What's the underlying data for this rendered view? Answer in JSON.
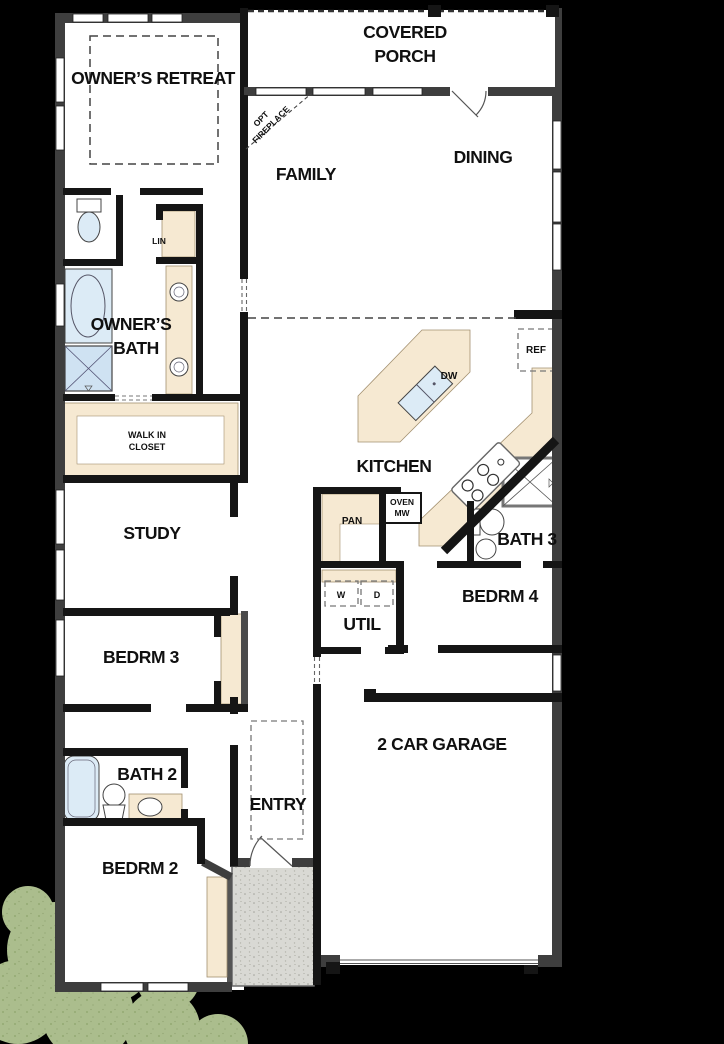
{
  "document": {
    "type": "residential-floor-plan",
    "background_color": "#000000"
  },
  "colors": {
    "exterior_wall": "#3e3e3e",
    "interior_wall": "#151515",
    "floor": "#ffffff",
    "cabinet_counter": "#f6e9d2",
    "plumbing_fixture": "#dcebf6",
    "stoop_concrete": "#d9d9d4",
    "bush_green": "#abbd8d",
    "label_text": "#101010"
  },
  "labels": {
    "owners_retreat": "OWNER’S RETREAT",
    "covered": "COVERED",
    "porch": "PORCH",
    "family": "FAMILY",
    "dining": "DINING",
    "opt": "OPT",
    "fireplace": "FIREPLACE",
    "lin": "LIN",
    "owners": "OWNER’S",
    "bath": "BATH",
    "walk_in": "WALK IN",
    "closet": "CLOSET",
    "kitchen": "KITCHEN",
    "dw": "DW",
    "ref": "REF",
    "study": "STUDY",
    "pan": "PAN",
    "oven": "OVEN",
    "mw": "MW",
    "bath3": "BATH 3",
    "bedrm4": "BEDRM 4",
    "util": "UTIL",
    "w": "W",
    "d": "D",
    "bedrm3": "BEDRM 3",
    "bath2": "BATH 2",
    "bedrm2": "BEDRM 2",
    "entry": "ENTRY",
    "garage": "2 CAR GARAGE"
  },
  "icons": {
    "toilet-icon": "tank rectangle + bowl ellipse",
    "tub-icon": "oval inside rectangle",
    "shower-icon": "square with X and drain marker",
    "sink-icon": "circle basin",
    "cooktop-icon": "four burner circles",
    "door-swing-icon": "quarter arc with leaf",
    "washer-dryer-icon": "dashed squares W / D",
    "refrigerator-icon": "dashed rectangle REF",
    "bed-icon": "dashed rectangle (optional bed location)",
    "bush-icon": "overlapping green circles",
    "porch-post-icon": "solid black square"
  }
}
